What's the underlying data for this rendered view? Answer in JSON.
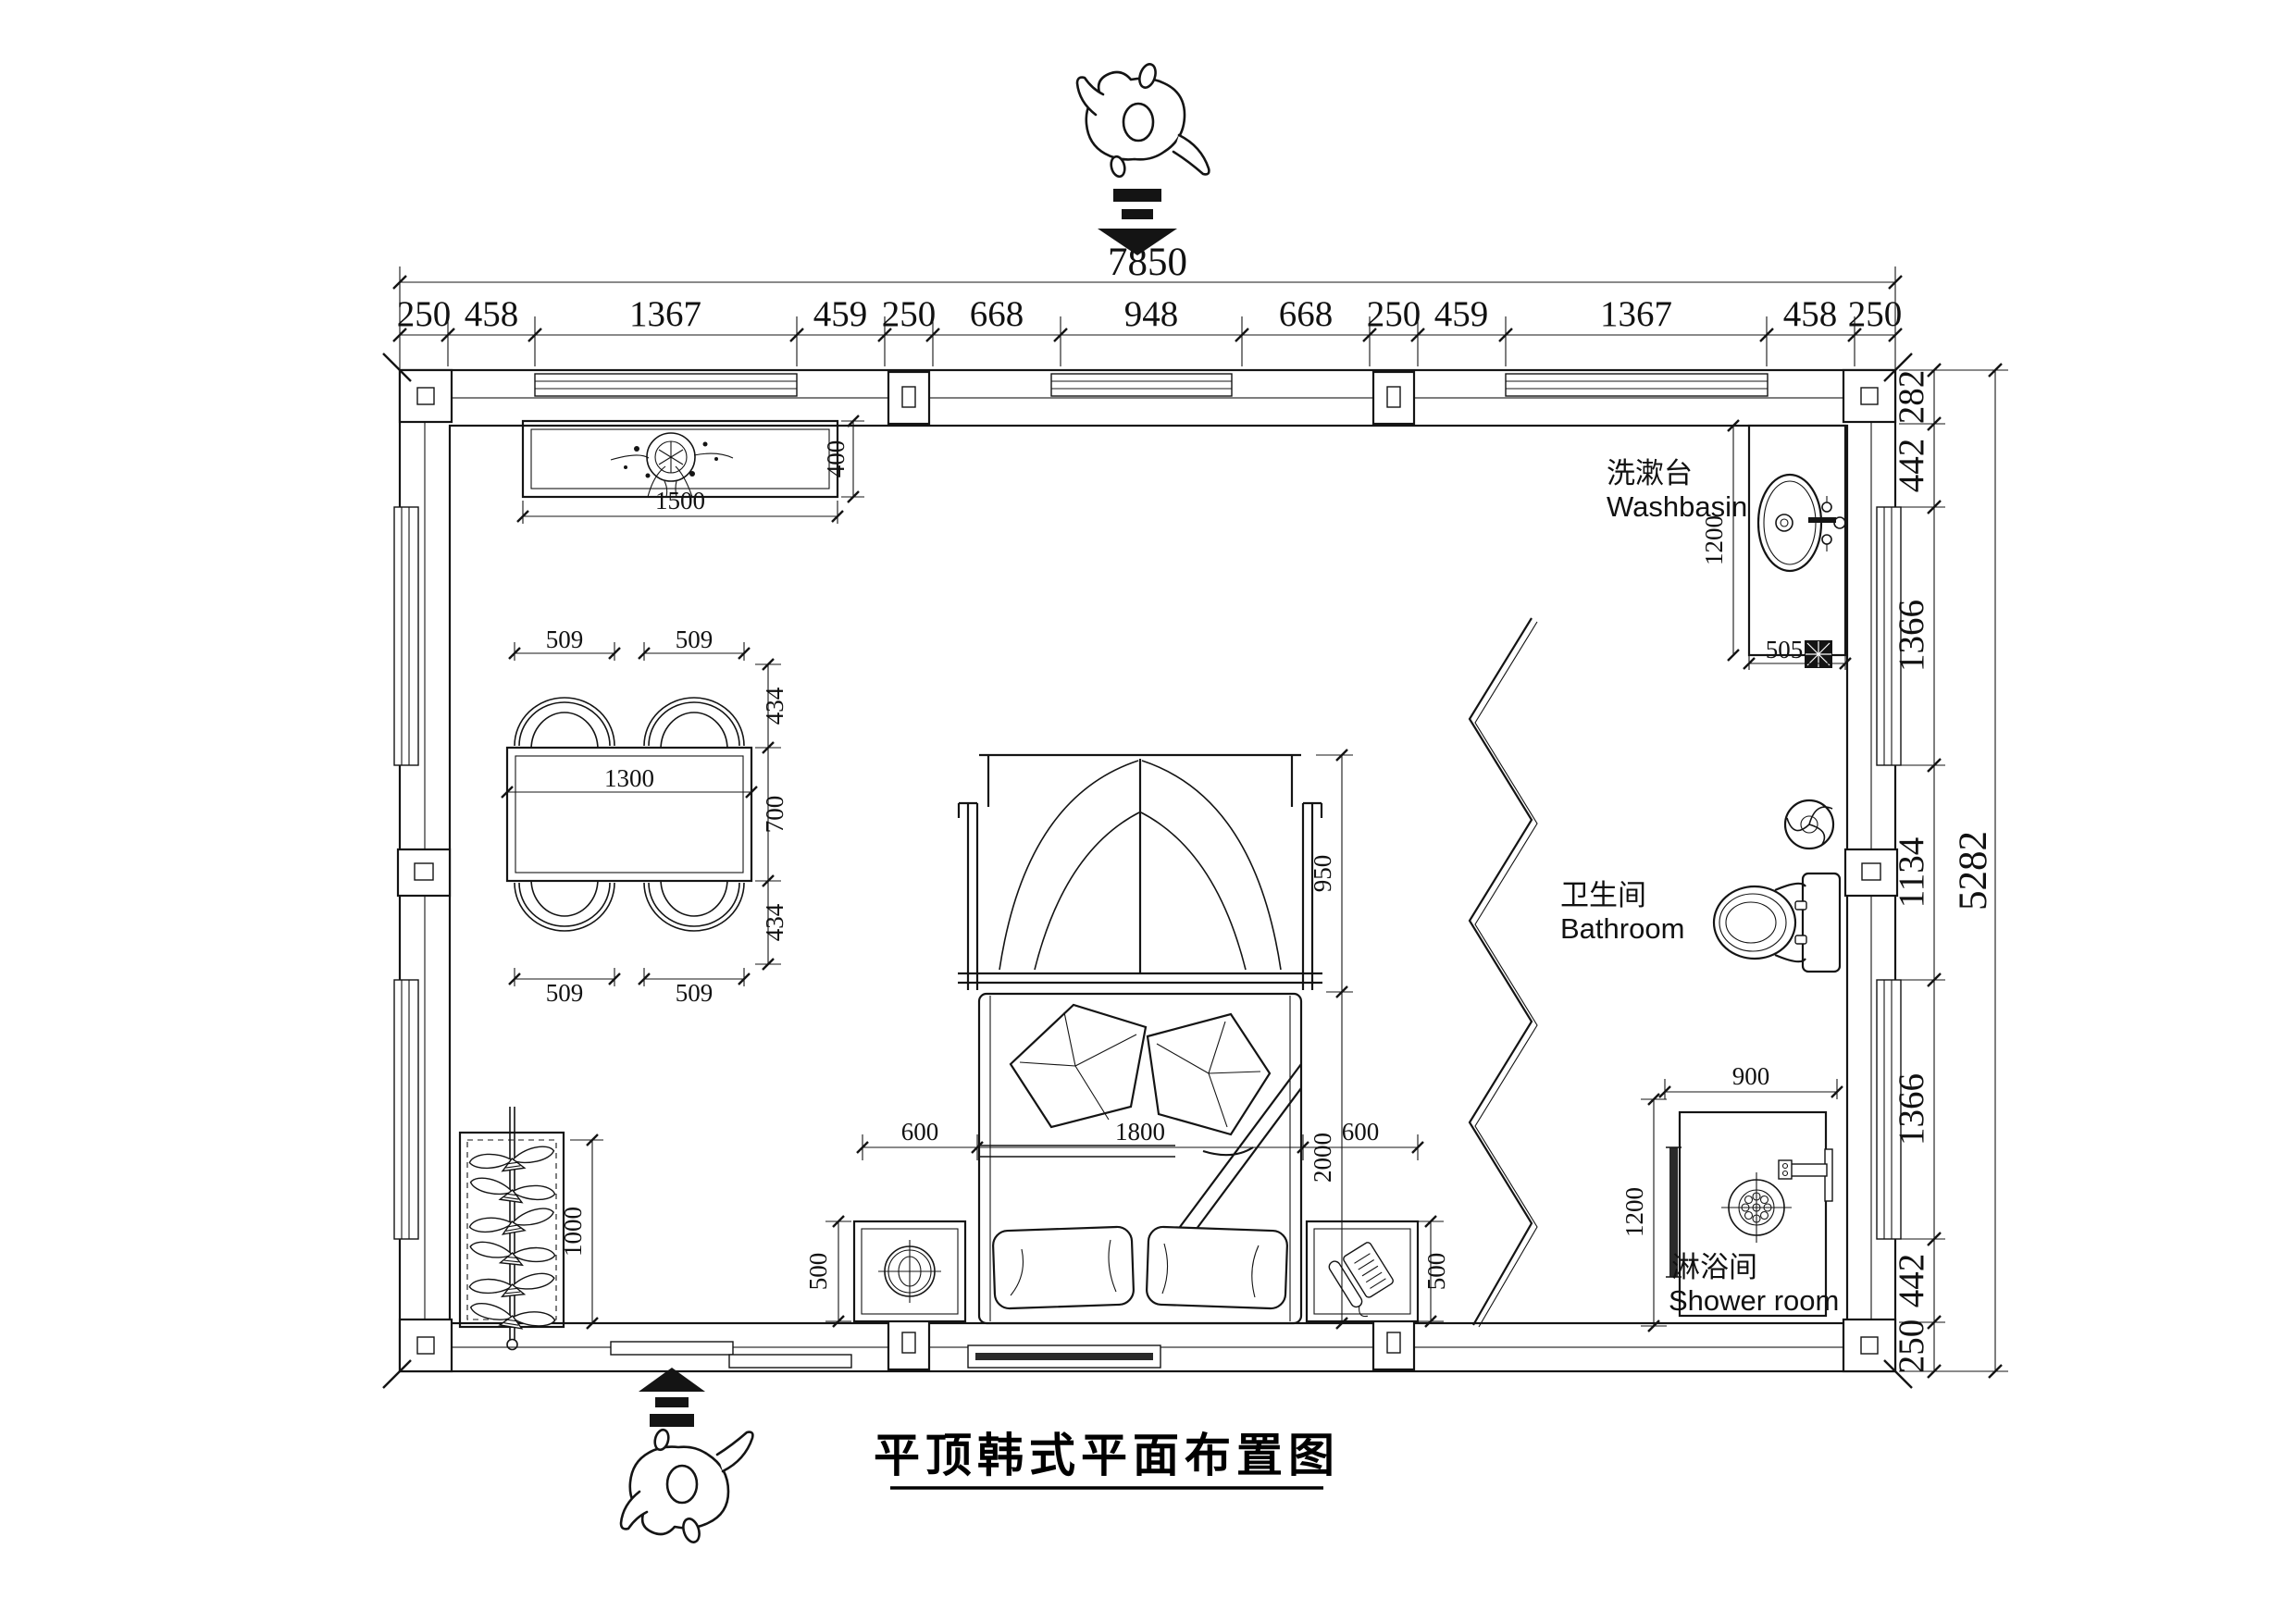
{
  "meta": {
    "title": "平顶韩式平面布置图"
  },
  "labels": {
    "washbasin_zh": "洗漱台",
    "washbasin_en": "Washbasin",
    "bathroom_zh": "卫生间",
    "bathroom_en": "Bathroom",
    "shower_zh": "淋浴间",
    "shower_en": "Shower room"
  },
  "dims": {
    "top_total": "7850",
    "top_chain": [
      "250",
      "458",
      "1367",
      "459",
      "250",
      "668",
      "948",
      "668",
      "250",
      "459",
      "1367",
      "458",
      "250"
    ],
    "right_total": "5282",
    "right_chain": [
      "282",
      "442",
      "1366",
      "1134",
      "1366",
      "442",
      "250"
    ],
    "cabinet": {
      "w": "1500",
      "d": "400"
    },
    "table": {
      "w": "1300",
      "d": "700",
      "chair_w": "509",
      "chair_d": "434"
    },
    "bed": {
      "w": "1800",
      "len": "2000",
      "head": "950",
      "side": "600",
      "stand": "500"
    },
    "wardrobe": {
      "len": "1000"
    },
    "basin": {
      "len": "1200",
      "w": "505"
    },
    "shower": {
      "w": "900",
      "d": "1200"
    }
  }
}
